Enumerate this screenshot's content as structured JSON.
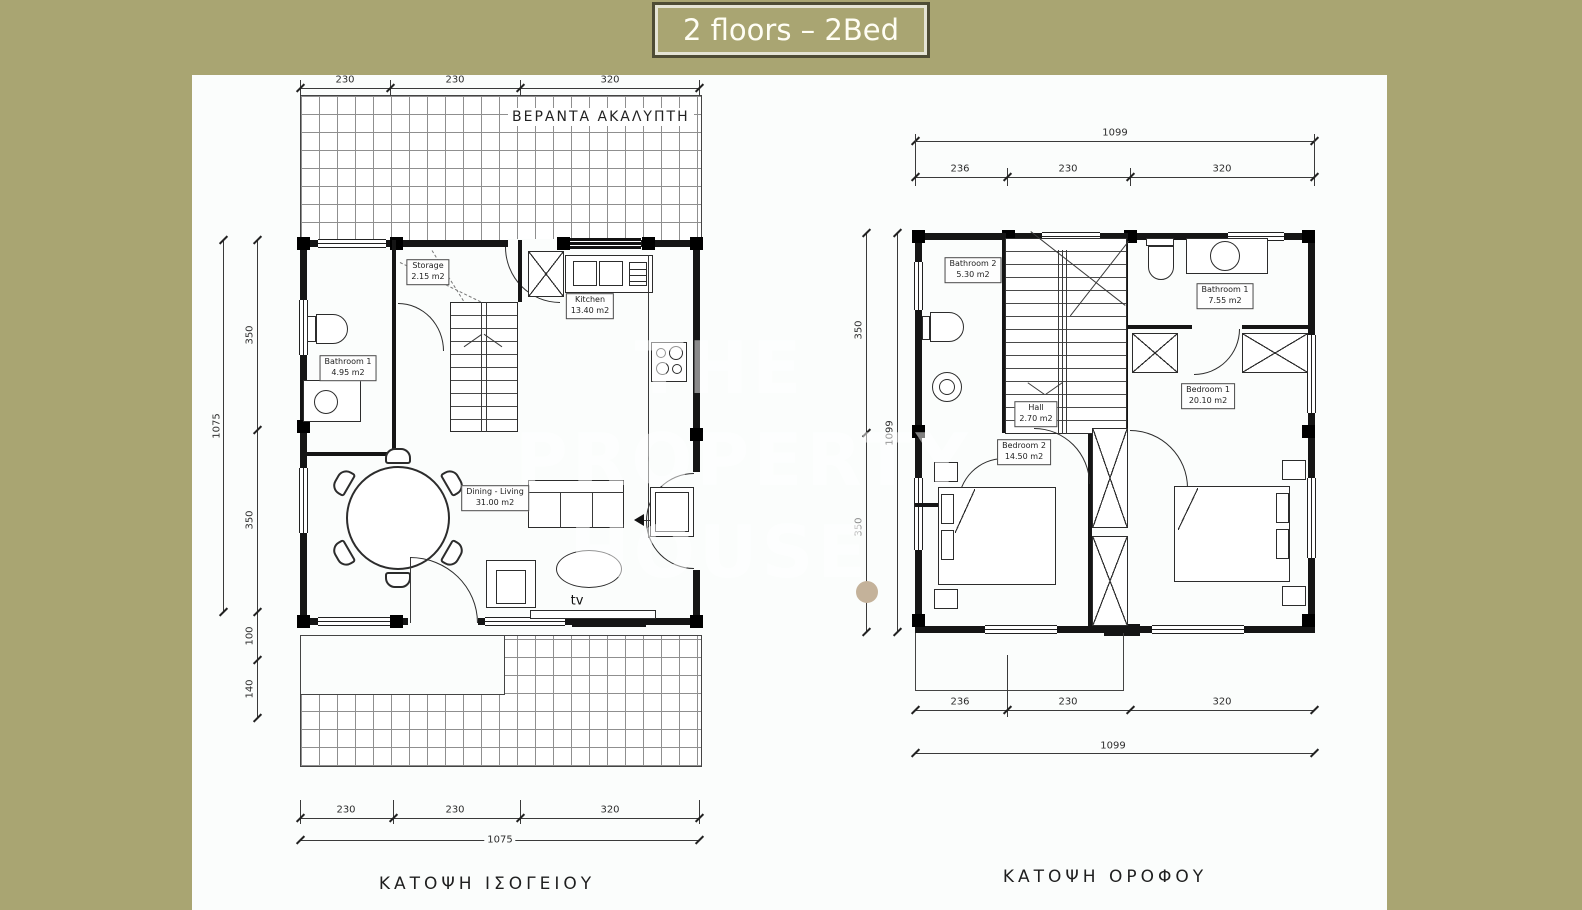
{
  "title": {
    "label": "2 floors – 2Bed"
  },
  "watermark": {
    "line1": "THE",
    "line2": "PROPERTY",
    "line3": "HOUSE"
  },
  "colors": {
    "background": "#a9a572",
    "paper": "#fbfdfc",
    "line": "#2c2c2c",
    "banner_border": "#4e4c35",
    "banner_text": "#fffef4",
    "watermark_dot": "#c4b29a"
  },
  "ground_floor": {
    "caption": "ΚΑΤΟΨΗ ΙΣΟΓΕΙΟΥ",
    "veranda_label": "ΒΕΡΑΝΤΑ ΑΚΑΛΥΠΤΗ",
    "rooms": {
      "storage": {
        "name": "Storage",
        "area": "2.15 m2"
      },
      "bathroom1": {
        "name": "Bathroom 1",
        "area": "4.95 m2"
      },
      "kitchen": {
        "name": "Kitchen",
        "area": "13.40 m2"
      },
      "living": {
        "name": "Dining - Living",
        "area": "31.00 m2"
      },
      "tv_label": "tv"
    },
    "dims": {
      "top": [
        "230",
        "230",
        "320"
      ],
      "left": [
        "350",
        "350",
        "100",
        "140"
      ],
      "left_total": "1075",
      "bottom": [
        "230",
        "230",
        "320"
      ],
      "bottom_total": "1075"
    }
  },
  "first_floor": {
    "caption": "ΚΑΤΟΨΗ ΟΡΟΦΟΥ",
    "rooms": {
      "bathroom2": {
        "name": "Bathroom 2",
        "area": "5.30 m2"
      },
      "bathroom1": {
        "name": "Bathroom 1",
        "area": "7.55 m2"
      },
      "hall": {
        "name": "Hall",
        "area": "2.70 m2"
      },
      "bedroom2": {
        "name": "Bedroom 2",
        "area": "14.50 m2"
      },
      "bedroom1": {
        "name": "Bedroom 1",
        "area": "20.10 m2"
      }
    },
    "dims": {
      "top_total": "1099",
      "top": [
        "236",
        "230",
        "320"
      ],
      "left": [
        "350",
        "350"
      ],
      "left_total": "1099",
      "bottom": [
        "236",
        "230",
        "320"
      ],
      "bottom_total": "1099"
    }
  }
}
